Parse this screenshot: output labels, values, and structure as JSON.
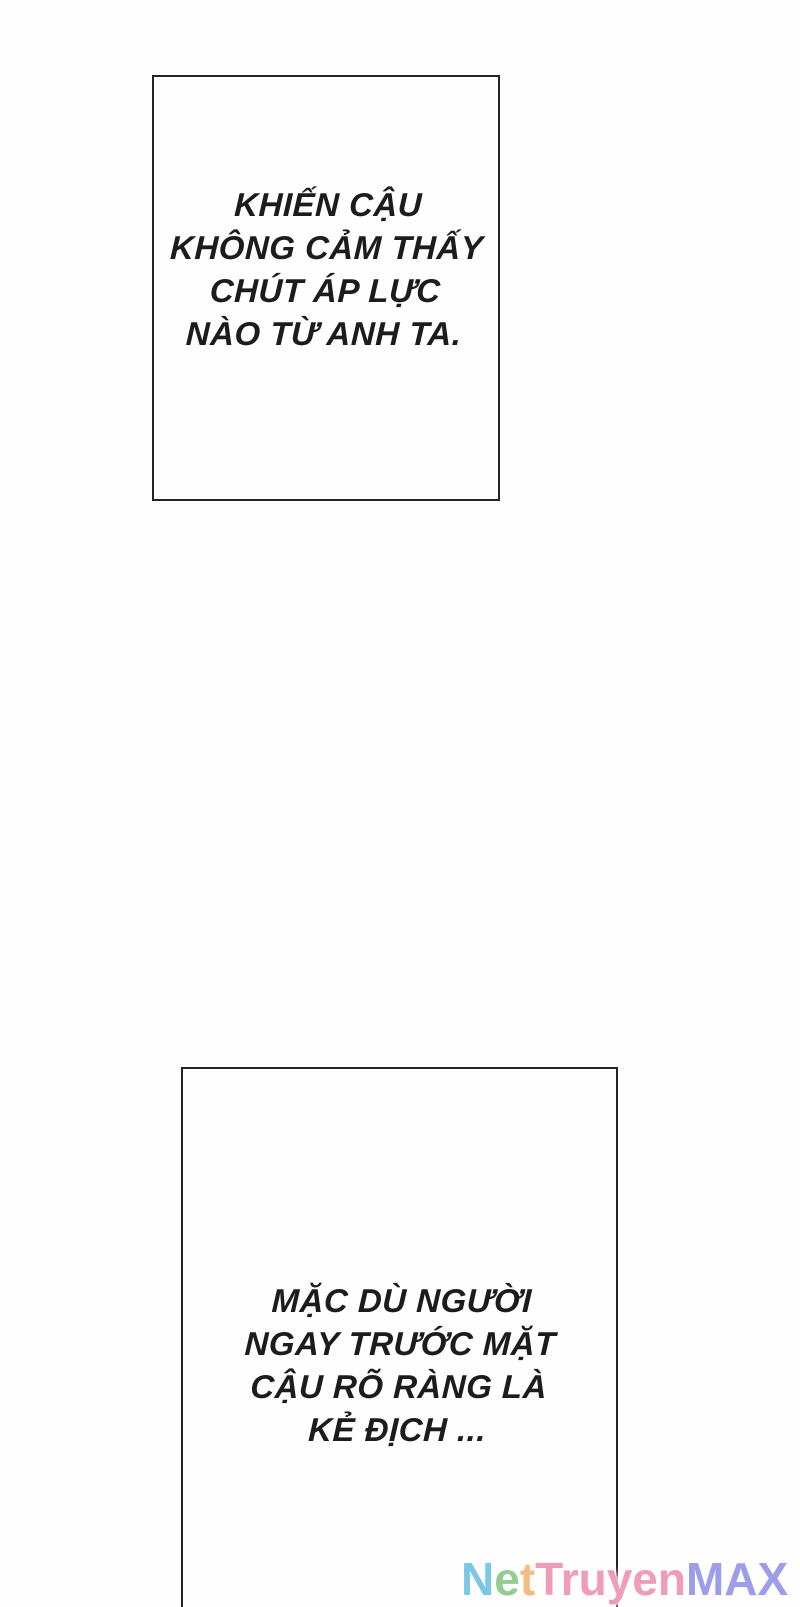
{
  "page": {
    "width": 800,
    "height": 1607,
    "background": "#fefefe",
    "text_color": "#1c1c1c",
    "panel_border_color": "#242424"
  },
  "panel1": {
    "lines": [
      "KHIẾN CẬU",
      "KHÔNG CẢM THẤY",
      "CHÚT ÁP LỰC",
      "NÀO TỪ ANH TA."
    ]
  },
  "panel2": {
    "lines": [
      "MẶC DÙ NGƯỜI",
      "NGAY TRƯỚC MẶT",
      "CẬU RÕ RÀNG LÀ",
      "KẺ ĐỊCH ..."
    ]
  },
  "watermark": {
    "name": "NetTruyenMAX",
    "segments": [
      {
        "text": "N",
        "color": "#7cc6e8"
      },
      {
        "text": "e",
        "color": "#93cd93"
      },
      {
        "text": "t",
        "color": "#f4bc7e"
      },
      {
        "text": "Truyen",
        "color": "#ee9cb8"
      },
      {
        "text": "MAX",
        "color": "#9d9de9"
      }
    ]
  }
}
